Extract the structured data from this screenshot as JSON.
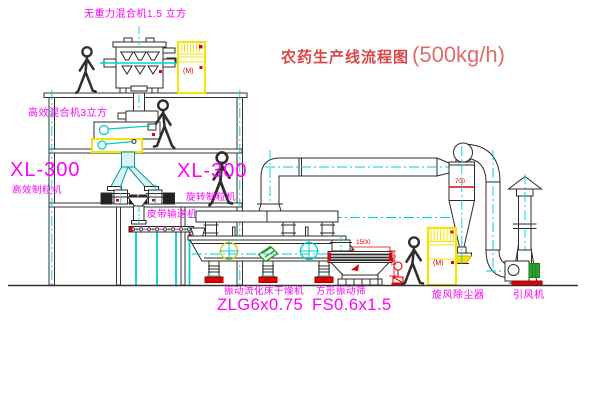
{
  "title": {
    "zh": "农药生产线流程图",
    "capacity": "(500kg/h)"
  },
  "labels": {
    "mixer_top": "无重力混合机1.5 立方",
    "mixer_2f": "高效混合机3立方",
    "granulator_left_model": "XL-300",
    "granulator_left_name": "高效制粒机",
    "granulator_right_model": "XL-300",
    "granulator_right_name": "旋转制粒机",
    "belt_conveyor": "皮带输送机",
    "dryer_name": "振动流化床干燥机",
    "dryer_model": "ZLG6x0.75",
    "sieve_name": "方形振动筛",
    "sieve_model": "FS0.6x1.5",
    "cyclone": "旋风除尘器",
    "fan": "引风机"
  },
  "dims": {
    "sieve_width": "1500",
    "sieve_height": "541",
    "cyclone_marking": "700"
  },
  "marks": {
    "cabinet1": "(M)",
    "cabinet2": "(M)"
  },
  "colors": {
    "line": "#2b2b2b",
    "cyan": "#00CFCF",
    "magenta": "#FF00FF",
    "red": "#E60000",
    "yellow": "#F5E400",
    "green": "#2FA32F",
    "title_red": "#D84848"
  }
}
